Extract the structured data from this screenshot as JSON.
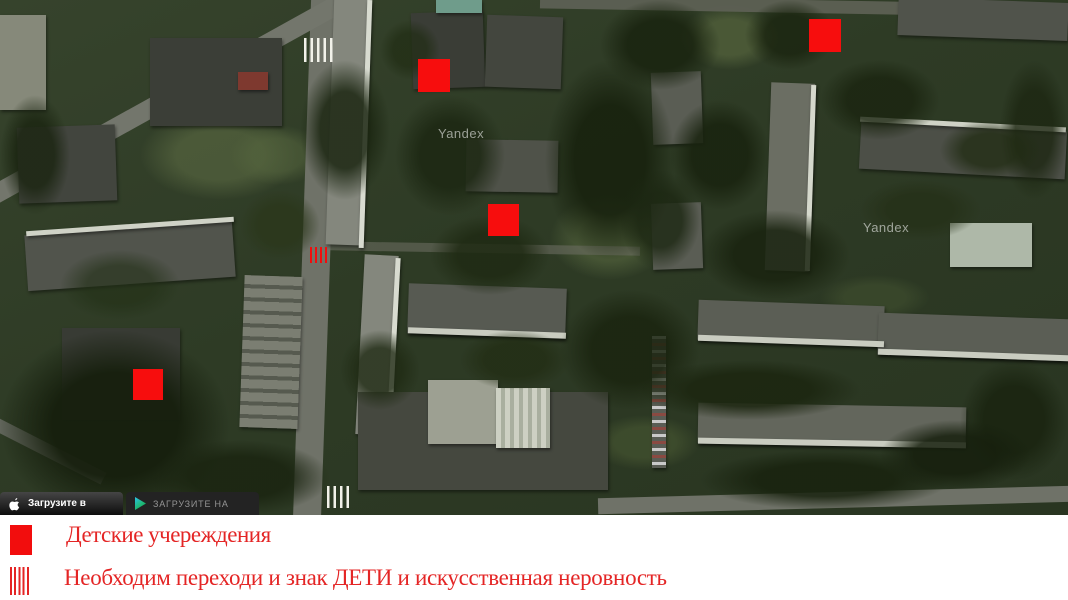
{
  "map": {
    "provider_watermark": "Yandex",
    "children_markers": [
      {
        "x": 418,
        "y": 59,
        "w": 32,
        "h": 33
      },
      {
        "x": 809,
        "y": 19,
        "w": 32,
        "h": 33
      },
      {
        "x": 488,
        "y": 204,
        "w": 31,
        "h": 32
      },
      {
        "x": 133,
        "y": 369,
        "w": 30,
        "h": 31
      }
    ],
    "crosswalk_marks": [
      {
        "x": 304,
        "y": 38,
        "w": 31,
        "h": 24,
        "color": "white"
      },
      {
        "x": 310,
        "y": 247,
        "w": 17,
        "h": 16,
        "color": "red"
      },
      {
        "x": 327,
        "y": 486,
        "w": 25,
        "h": 22,
        "color": "white"
      }
    ],
    "app_badges": [
      {
        "icon": "apple-logo",
        "label": "Загрузите в"
      },
      {
        "icon": "google-play-logo",
        "label": "ЗАГРУЗИТЕ НА"
      }
    ]
  },
  "legend": {
    "items": [
      {
        "icon": "red-square",
        "label": "Детские учереждения"
      },
      {
        "icon": "red-hatch",
        "label": "Необходим переходи и знак ДЕТИ и искусственная неровность"
      }
    ]
  },
  "colors": {
    "marker_red": "#f70d0d",
    "legend_text_red": "#e42525",
    "legend_bg": "#ffffff"
  }
}
